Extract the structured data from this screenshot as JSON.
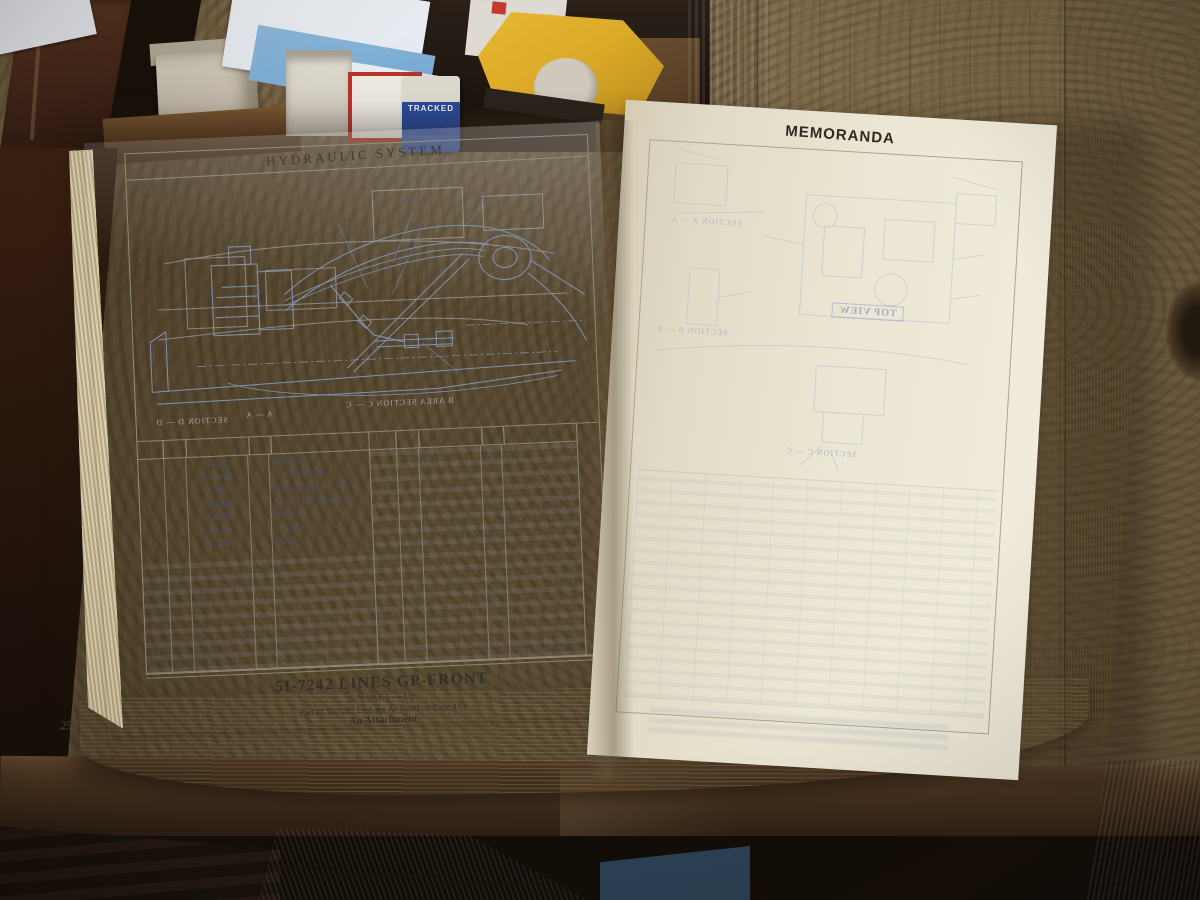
{
  "scene": {
    "background": {
      "tracked_label": "TRACKED",
      "colors": {
        "plywood": "#7a684c",
        "dark_wood": "#301a0e",
        "page_cream": "#ece6d4",
        "diagram_blue": "#8093b3",
        "bleed_blue": "#b3bccf",
        "denim": "#4c6a89",
        "dispenser_yellow": "#d9a827",
        "label_blue": "#2b4a99"
      }
    },
    "book": {
      "left_page": {
        "header": "HYDRAULIC SYSTEM",
        "diagram": {
          "callouts": [
            "1",
            "2-3-4",
            "5",
            "4-6",
            "7"
          ],
          "bleedthrough_labels": [
            "A — A",
            "SECTION D — D",
            "B AREA SECTION C — C"
          ]
        },
        "table": {
          "headers": [
            "NOTE",
            "No.",
            "PART No.",
            "QTY",
            "PART NAME"
          ],
          "rows": [
            {
              "no": "1",
              "part_no": "5I-7243",
              "qty": "1",
              "part_name": "TUBE AS"
            },
            {
              "no": "2",
              "part_no": "6V-8635",
              "qty": "1",
              "part_name": "CONNECTOR"
            },
            {
              "no": "3",
              "part_no": "5K-9090",
              "qty": "1",
              "part_name": "SEAL (23.52mm ID)"
            },
            {
              "no": "4",
              "part_no": "7M-8485",
              "qty": "2",
              "part_name": "SEAL (29.74mm ID)"
            },
            {
              "no": "5",
              "part_no": "4I-8789",
              "qty": "1",
              "part_name": "VALVE GP"
            },
            {
              "no": "6",
              "part_no": "5I-7244",
              "qty": "1",
              "part_name": "TUBE AS"
            },
            {
              "no": "7",
              "part_no": "1P-3703",
              "qty": "2",
              "part_name": "SEAL"
            }
          ],
          "plate_code": "H35076E"
        },
        "caption": {
          "title": "5I-7242 LINES GP-FRONT",
          "serial": "S/N 9KK1 — Up",
          "note": "Part of 5I-7287 Linkage Ar listed on Page 413",
          "attachment": "An Attachment"
        },
        "page_number": "258"
      },
      "right_page": {
        "header": "MEMORANDA",
        "bleedthrough_labels": [
          "SECTION A — A",
          "SECTION B — B",
          "SECTION C — C",
          "TOP VIEW"
        ]
      }
    }
  }
}
